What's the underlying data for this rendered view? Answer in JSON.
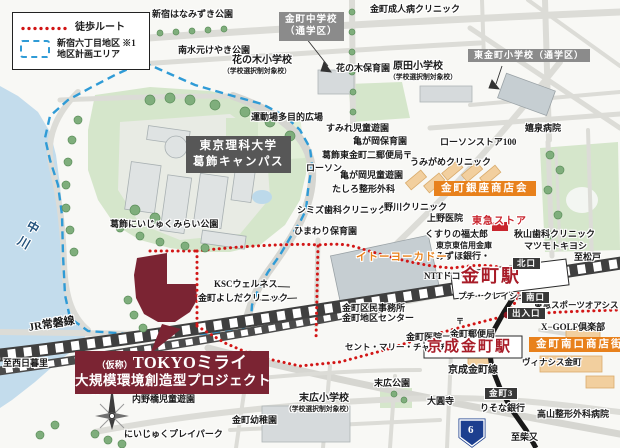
{
  "map": {
    "legend": {
      "walk_route": "徒歩ルート",
      "district_line1": "新宿六丁目地区 ※1",
      "district_line2": "地区計画エリア"
    },
    "project": {
      "prefix": "（仮称）",
      "name": "TOKYOミライ",
      "line2": "大規模環境創造型プロジェクト"
    },
    "campus": {
      "line1": "東京理科大学",
      "line2": "葛飾キャンパス"
    },
    "school_zone_jhs": {
      "line1": "金町中学校",
      "line2": "（通学区）"
    },
    "compass_n": "N",
    "labels": [
      {
        "t": "新宿はなみずき公園",
        "x": 152,
        "y": 10,
        "name": "label-shinjuku-hanamizuki-park"
      },
      {
        "t": "南水元けやき公園",
        "x": 178,
        "y": 46,
        "name": "label-minamimizumoto-keyaki-park"
      },
      {
        "t": "花の木小学校",
        "x": 232,
        "y": 56,
        "fs": 10,
        "name": "label-hananoki-elementary"
      },
      {
        "t": "（学校選択制対象校）",
        "x": 223,
        "y": 68,
        "cls": "sub",
        "name": "label-school-choice-note"
      },
      {
        "t": "花の木保育園",
        "x": 336,
        "y": 64,
        "name": "label-hananoki-nursery"
      },
      {
        "t": "原田小学校",
        "x": 393,
        "y": 62,
        "fs": 10,
        "name": "label-harada-elementary"
      },
      {
        "t": "（学校選択制対象校）",
        "x": 389,
        "y": 74,
        "cls": "sub",
        "name": "label-school-choice-note"
      },
      {
        "t": "金町成人病クリニック",
        "x": 370,
        "y": 5,
        "name": "label-kanamachi-seijinbyo-clinic"
      },
      {
        "t": "東金町小学校（通学区）",
        "x": 468,
        "y": 49,
        "cls": "gray-box",
        "name": "school-zone-higashikanamachi"
      },
      {
        "t": "運動場多目的広場",
        "x": 251,
        "y": 113,
        "name": "label-playfield-plaza"
      },
      {
        "t": "すみれ児童遊園",
        "x": 326,
        "y": 124,
        "name": "label-sumire-playground"
      },
      {
        "t": "亀が岡保育園",
        "x": 353,
        "y": 137,
        "name": "label-kamegaoka-nursery"
      },
      {
        "t": "葛飾東金町二郵便局〒",
        "x": 322,
        "y": 151,
        "name": "label-post-office"
      },
      {
        "t": "ローソン",
        "x": 306,
        "y": 164,
        "name": "label-lawson"
      },
      {
        "t": "亀が岡児童遊園",
        "x": 340,
        "y": 171,
        "name": "label-kamegaoka-playground"
      },
      {
        "t": "たしろ整形外科",
        "x": 332,
        "y": 185,
        "name": "label-tashiro-orthopedics"
      },
      {
        "t": "シミズ歯科クリニック",
        "x": 297,
        "y": 206,
        "name": "label-shimizu-dental"
      },
      {
        "t": "ひまわり保育園",
        "x": 294,
        "y": 227,
        "name": "label-himawari-nursery"
      },
      {
        "t": "葛飾にいじゅくみらい公園",
        "x": 110,
        "y": 220,
        "name": "label-niijuku-mirai-park"
      },
      {
        "t": "野川クリニック",
        "x": 384,
        "y": 203,
        "name": "label-nogawa-clinic"
      },
      {
        "t": "ローソンストア100",
        "x": 440,
        "y": 138,
        "name": "label-lawson-store-100"
      },
      {
        "t": "うみがめクリニック",
        "x": 410,
        "y": 158,
        "name": "label-umigame-clinic"
      },
      {
        "t": "嬉泉病院",
        "x": 525,
        "y": 124,
        "name": "label-kisen-hospital"
      },
      {
        "t": "上野医院",
        "x": 427,
        "y": 214,
        "name": "label-ueno-clinic"
      },
      {
        "t": "くすりの福太郎",
        "x": 425,
        "y": 230,
        "name": "label-fukutaro-drugstore"
      },
      {
        "t": "東京東信用金庫",
        "x": 436,
        "y": 242,
        "fs": 8,
        "name": "label-tokyo-higashi-shinkin"
      },
      {
        "t": "みずほ銀行・",
        "x": 436,
        "y": 252,
        "name": "label-mizuho-bank"
      },
      {
        "t": "NTTドコモ",
        "x": 424,
        "y": 272,
        "name": "label-ntt-docomo"
      },
      {
        "t": "プチ・クレイシュ",
        "x": 458,
        "y": 292,
        "fs": 8.5,
        "name": "label-petit-creche"
      },
      {
        "t": "秋山歯科クリニック",
        "x": 514,
        "y": 230,
        "name": "label-akiyama-dental"
      },
      {
        "t": "マツモトキヨシ",
        "x": 524,
        "y": 242,
        "name": "label-matsumotokiyoshi"
      },
      {
        "t": "東急スポーツオアシス",
        "x": 534,
        "y": 301,
        "fs": 8.5,
        "name": "label-tokyu-sports-oasis"
      },
      {
        "t": "X−GOLF倶楽部",
        "x": 541,
        "y": 323,
        "name": "label-xgolf-club"
      },
      {
        "t": "ヴィナシス金町",
        "x": 522,
        "y": 358,
        "fs": 8.5,
        "name": "label-vinacis-kanamachi"
      },
      {
        "t": "金町医院",
        "x": 406,
        "y": 333,
        "name": "label-kanamachi-clinic"
      },
      {
        "t": "〒",
        "x": 456,
        "y": 318,
        "fs": 8,
        "name": "post-mark"
      },
      {
        "t": "金町郵便局",
        "x": 450,
        "y": 330,
        "name": "label-kanamachi-post-office"
      },
      {
        "t": "金町区民事務所",
        "x": 342,
        "y": 304,
        "name": "label-ward-office"
      },
      {
        "t": "金町地区センター",
        "x": 342,
        "y": 314,
        "name": "label-district-center"
      },
      {
        "t": "セント・マリー・チャーチ",
        "x": 345,
        "y": 343,
        "fs": 8.5,
        "name": "label-st-mary-church"
      },
      {
        "t": "末広児童遊園",
        "x": 204,
        "y": 383,
        "name": "label-suehiro-playground"
      },
      {
        "t": "末広小学校",
        "x": 299,
        "y": 394,
        "fs": 10,
        "name": "label-suehiro-elementary"
      },
      {
        "t": "（学校選択制対象校）",
        "x": 285,
        "y": 406,
        "cls": "sub",
        "name": "label-school-choice-note"
      },
      {
        "t": "末広公園",
        "x": 374,
        "y": 379,
        "name": "label-suehiro-park"
      },
      {
        "t": "金町幼稚園",
        "x": 232,
        "y": 416,
        "name": "label-kanamachi-kindergarten"
      },
      {
        "t": "内野橋児童遊園",
        "x": 132,
        "y": 395,
        "name": "label-uchinobashi-playground"
      },
      {
        "t": "にいじゅくプレイパーク",
        "x": 124,
        "y": 430,
        "name": "label-niijuku-playpark"
      },
      {
        "t": "大圓寺",
        "x": 427,
        "y": 397,
        "name": "label-daienji-temple"
      },
      {
        "t": "りそな銀行",
        "x": 480,
        "y": 404,
        "name": "label-resona-bank"
      },
      {
        "t": "高山整形外科病院",
        "x": 537,
        "y": 410,
        "name": "label-takayama-orthopedics"
      },
      {
        "t": "KSCウェルネス",
        "x": 214,
        "y": 280,
        "name": "label-ksc-wellness"
      },
      {
        "t": "金町よしだクリニック",
        "x": 198,
        "y": 294,
        "name": "label-yoshida-clinic"
      },
      {
        "t": "京成金町線",
        "x": 448,
        "y": 366,
        "fs": 10,
        "name": "label-keisei-kanamachi-line"
      },
      {
        "t": "JR常磐線",
        "x": 28,
        "y": 323,
        "fs": 11,
        "rot": -9,
        "name": "label-jr-joban-line"
      },
      {
        "t": "中川",
        "x": 30,
        "y": 218,
        "cls": "vertical",
        "rot": 30,
        "name": "label-nakagawa-river"
      },
      {
        "t": "至松戸",
        "x": 574,
        "y": 253,
        "name": "label-to-matsudo"
      },
      {
        "t": "至柴又",
        "x": 511,
        "y": 433,
        "name": "label-to-shibamata"
      },
      {
        "t": "至西日暮里",
        "x": 3,
        "y": 359,
        "name": "label-to-nishinippori"
      },
      {
        "t": "イトーヨーカドー",
        "x": 356,
        "y": 252,
        "cls": "orange-text",
        "name": "label-ito-yokado"
      },
      {
        "t": "東急ストア",
        "x": 472,
        "y": 217,
        "cls": "red-text",
        "name": "label-tokyu-store"
      },
      {
        "t": "金町銀座商店会",
        "x": 434,
        "y": 181,
        "cls": "orange-box",
        "name": "label-kanamachi-ginza-shotenkai"
      },
      {
        "t": "金町南口商店街",
        "x": 529,
        "y": 337,
        "cls": "orange-box",
        "name": "label-minamiguchi-shotengai"
      },
      {
        "t": "金町駅",
        "x": 461,
        "y": 267,
        "cls": "station",
        "name": "label-jr-kanamachi-station"
      },
      {
        "t": "京成金町駅",
        "x": 427,
        "y": 340,
        "cls": "station station2",
        "name": "label-keisei-kanamachi-station"
      },
      {
        "t": "北口",
        "x": 512,
        "y": 257,
        "cls": "dark-box",
        "name": "label-north-exit"
      },
      {
        "t": "南口",
        "x": 521,
        "y": 291,
        "cls": "dark-box",
        "name": "label-south-exit"
      },
      {
        "t": "出入口",
        "x": 507,
        "y": 307,
        "cls": "dark-box",
        "name": "label-entrance"
      },
      {
        "t": "金町3",
        "x": 484,
        "y": 387,
        "cls": "dark-box",
        "name": "label-kanamachi-3-intersection"
      },
      {
        "t": "6",
        "x": 468,
        "y": 425,
        "cls": "shield",
        "name": "label-route-6"
      }
    ]
  },
  "colors": {
    "walk_route_red": "#d21616",
    "district_blue": "#2f9bd6",
    "project_maroon": "#7b2433",
    "station_red": "#a81c28",
    "shopping_orange": "#e8811c",
    "tokyu_store_red": "#c9252d",
    "park_green": "#d5e6cb",
    "water_blue": "#c3dcec",
    "rail_gray": "#3f3f3f",
    "route6_shield_blue": "#1d3f8f"
  }
}
